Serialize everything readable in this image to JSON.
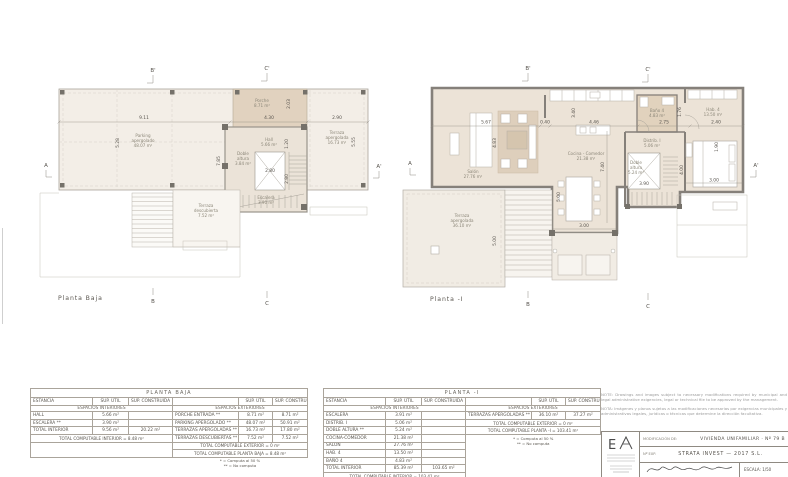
{
  "plans": {
    "baja": {
      "title": "Planta  Baja",
      "markers": {
        "bp": "B'",
        "cp": "C'",
        "a": "A",
        "ap": "A'",
        "b": "B",
        "c": "C"
      },
      "rooms": {
        "parking": {
          "l1": "Parking",
          "l2": "apergolado",
          "area": "48.07 m²"
        },
        "porche": {
          "l1": "Porche",
          "area": "8.71 m²"
        },
        "hall": {
          "l1": "Hall",
          "area": "5.66 m²"
        },
        "doble_altura": {
          "l1": "Doble",
          "l2": "altura",
          "area": "3.84 m²"
        },
        "escalera": {
          "l1": "Escalera",
          "area": "3.90 m²"
        },
        "terraza_apergolada": {
          "l1": "Terraza",
          "l2": "apergolada",
          "area": "16.73 m²"
        },
        "terraza_descubierta": {
          "l1": "Terraza",
          "l2": "descubierta",
          "area": "7.52 m²"
        }
      },
      "dims": {
        "w_parking": "9.11",
        "h_parking": "5.28",
        "h_mid": "7.85",
        "w_porche": "4.30",
        "h_porche": "2.03",
        "h_hall": "1.20",
        "w_stair": "2.80",
        "h_stair": "2.80",
        "w_terraza": "2.90",
        "h_terraza": "5.55"
      }
    },
    "menos1": {
      "title": "Planta  -I",
      "markers": {
        "bp": "B'",
        "cp": "C'",
        "a": "A",
        "ap": "A'",
        "b": "B",
        "c": "C"
      },
      "rooms": {
        "salon": {
          "l1": "Salón",
          "area": "27.76 m²"
        },
        "cocina": {
          "l1": "Cocina - Comedor",
          "area": "21.38 m²"
        },
        "distrib": {
          "l1": "Distrib. I",
          "area": "5.06 m²"
        },
        "doble_altura": {
          "l1": "Doble",
          "l2": "altura",
          "area": "5.24 m²"
        },
        "bano": {
          "l1": "Baño 4",
          "area": "4.83 m²"
        },
        "hab": {
          "l1": "Hab. 4",
          "area": "13.50 m²"
        },
        "terraza": {
          "l1": "Terraza",
          "l2": "apergolada",
          "area": "36.10 m²"
        }
      },
      "dims": {
        "w_salon": "5.67",
        "w_gap": "0.40",
        "w_cocina": "4.46",
        "w_bano": "2.75",
        "w_dorm": "2.40",
        "h_salon": "4.83",
        "h_kitchen": "3.40",
        "h_comedor": "7.40",
        "h_bano": "1.76",
        "h_mesa": "5.00",
        "w_mesa": "3.00",
        "w_stair": "3.90",
        "h_stair": "4.00",
        "w_cama": "3.00",
        "h_cama": "1.90",
        "h_terraza": "5.00"
      }
    }
  },
  "tables": {
    "headers": {
      "estancia": "ESTANCIA",
      "util": "SUP. ÚTIL",
      "construida": "SUP. CONSTRUIDA"
    },
    "int_title": "ESPACIOS INTERIORES",
    "ext_title": "ESPACIOS EXTERIORES",
    "baja": {
      "title": "PLANTA BAJA",
      "rows_int": [
        [
          "HALL",
          "5.66 m²",
          ""
        ],
        [
          "ESCALERA **",
          "3.90 m²",
          ""
        ],
        [
          "TOTAL INTERIOR",
          "9.56 m²",
          "20.22 m²"
        ]
      ],
      "total_int": "TOTAL COMPUTABLE INTERIOR = 8.48 m²",
      "rows_ext": [
        [
          "PORCHE ENTRADA **",
          "8.71 m²",
          "8.71 m²"
        ],
        [
          "PARKING APERGOLADO **",
          "48.07 m²",
          "50.91 m²"
        ],
        [
          "TERRAZAS APERGOLADAS **",
          "16.73 m²",
          "17.80 m²"
        ],
        [
          "TERRAZAS DESCUBIERTAS **",
          "7.52 m²",
          "7.52 m²"
        ]
      ],
      "total_ext": "TOTAL COMPUTABLE EXTERIOR = 0 m²",
      "total_planta": "TOTAL COMPUTABLE PLANTA BAJA = 8.48 m²",
      "fn1": "* = Computa al 50 %",
      "fn2": "** = No computa"
    },
    "menos1": {
      "title": "PLANTA  -I",
      "rows_int": [
        [
          "ESCALERA",
          "3.91 m²",
          ""
        ],
        [
          "DISTRIB. I",
          "5.06 m²",
          ""
        ],
        [
          "DOBLE ALTURA **",
          "5.24 m²",
          ""
        ],
        [
          "COCINA-COMEDOR",
          "21.38 m²",
          ""
        ],
        [
          "SALÓN",
          "27.76 m²",
          ""
        ],
        [
          "HAB. 4",
          "13.50 m²",
          ""
        ],
        [
          "BAÑO 4",
          "4.83 m²",
          ""
        ],
        [
          "TOTAL INTERIOR",
          "85.39 m²",
          "103.65 m²"
        ]
      ],
      "total_int": "TOTAL COMPUTABLE INTERIOR = 103.41 m²",
      "rows_ext": [
        [
          "TERRAZAS APERGOLADAS **",
          "36.10 m²",
          "37.27 m²"
        ]
      ],
      "total_ext": "TOTAL COMPUTABLE EXTERIOR = 0 m²",
      "total_planta": "TOTAL COMPUTABLE PLANTA  -I = 103.41 m²",
      "fn1": "* = Computa al 50 %",
      "fn2": "** = No computa"
    }
  },
  "title_block": {
    "note_en": "NOTE: Drawings and images subject to necessary modifications required by municipal and legal administrative exigencies, legal or technical file to be approved by the management.",
    "note_es": "NOTA: Imágenes y planos sujetos a las modificaciones necesarias por exigencias municipales y administrativas legales, jurídicas o técnicas que determine la dirección facultativa.",
    "logo_letter": "E",
    "field1_label": "MODIFICACIÓN DE:",
    "field1_value": "VIVIENDA UNIFAMILIAR  ·  Nº 79 B",
    "field2_label": "Nº EXP.",
    "field2_value": "STRATA INVEST — 2017 S.L.",
    "escala": "ESCALA:  1/50"
  }
}
